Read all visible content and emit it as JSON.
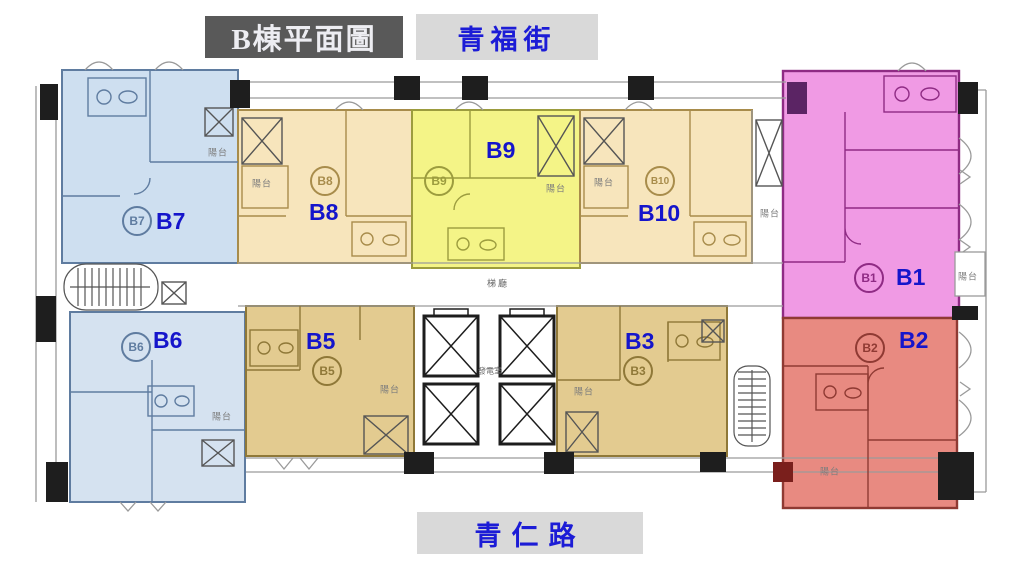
{
  "title": {
    "text": "B棟平面圖",
    "bg": "#595959",
    "color": "#EDEDF2"
  },
  "streets": {
    "top": "青福街",
    "bottom": "青仁路",
    "bg": "#D9D9D9",
    "color": "#1C1CD6"
  },
  "plan": {
    "balcony_label": "陽台",
    "elevator_hall_label": "梯廳",
    "generator_room_label": "發電室",
    "label_color": "#1515CB"
  },
  "units": {
    "b1": {
      "label": "B1",
      "circle": "B1",
      "fill": "#F09AE4",
      "wall": "#8F2B84"
    },
    "b2": {
      "label": "B2",
      "circle": "B2",
      "fill": "#E88A81",
      "wall": "#8F3A33"
    },
    "b3": {
      "label": "B3",
      "circle": "B3",
      "fill": "#E3CB90",
      "wall": "#8F7838"
    },
    "b5": {
      "label": "B5",
      "circle": "B5",
      "fill": "#E3CB90",
      "wall": "#8F7838"
    },
    "b6": {
      "label": "B6",
      "circle": "B6",
      "fill": "#D5E2F0",
      "wall": "#5F7CA0"
    },
    "b7": {
      "label": "B7",
      "circle": "B7",
      "fill": "#CEDFF0",
      "wall": "#5F7CA0"
    },
    "b8": {
      "label": "B8",
      "circle": "B8",
      "fill": "#F7E5BC",
      "wall": "#A88C4B"
    },
    "b9": {
      "label": "B9",
      "circle": "B9",
      "fill": "#F4F487",
      "wall": "#9C9C3E"
    },
    "b10": {
      "label": "B10",
      "circle": "B10",
      "fill": "#F7E5BC",
      "wall": "#A88C4B"
    }
  }
}
